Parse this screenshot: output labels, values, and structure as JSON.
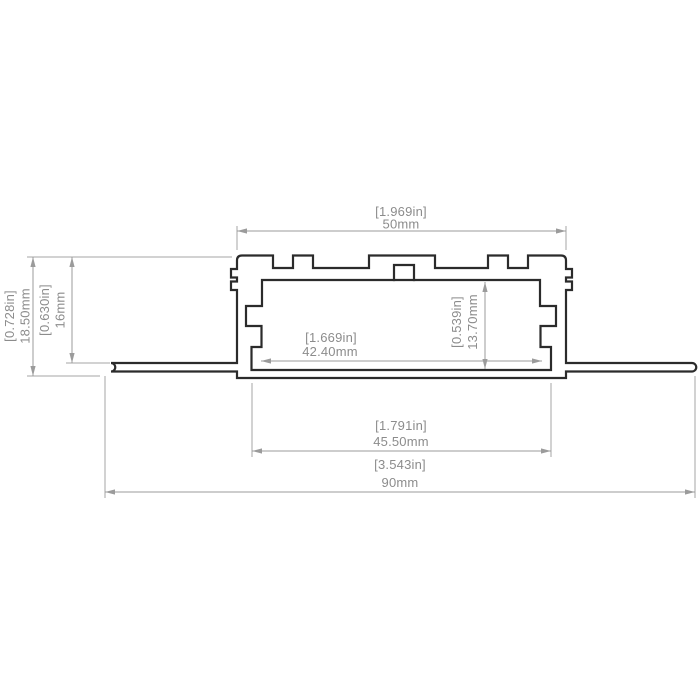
{
  "drawing": {
    "type": "technical-cross-section",
    "subject": "recessed LED aluminium profile cross-section with mounting flanges",
    "colors": {
      "background": "#ffffff",
      "profile_outline": "#2b2b2b",
      "dimension_lines": "#9b9b9b",
      "dimension_text": "#8c8c8c"
    },
    "dims": {
      "top_width": {
        "inch": "[1.969in]",
        "metric": "50mm"
      },
      "overall_height": {
        "inch": "[0.728in]",
        "metric": "18.50mm"
      },
      "flange_height": {
        "inch": "[0.630in]",
        "metric": "16mm"
      },
      "inner_width": {
        "inch": "[1.669in]",
        "metric": "42.40mm"
      },
      "inner_height": {
        "inch": "[0.539in]",
        "metric": "13.70mm"
      },
      "cover_width": {
        "inch": "[1.791in]",
        "metric": "45.50mm"
      },
      "overall_width": {
        "inch": "[3.543in]",
        "metric": "90mm"
      }
    }
  }
}
